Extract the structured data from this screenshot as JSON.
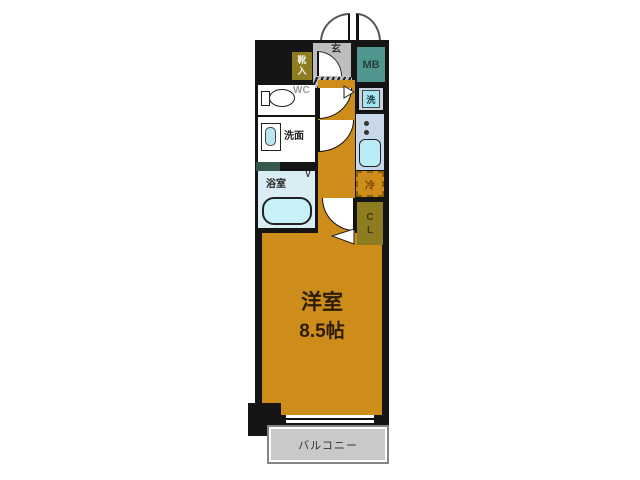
{
  "title": "floor-plan",
  "unit": {
    "main_room": {
      "name_line": "洋室",
      "size_line": "8.5帖"
    },
    "balcony": {
      "label": "バルコニー"
    },
    "entrance": {
      "label": "玄"
    },
    "shoe_cabinet": {
      "char_top": "靴",
      "char_bottom": "入"
    },
    "meter_box": {
      "label": "MB"
    },
    "toilet": {
      "label": "WC"
    },
    "washroom": {
      "label": "洗面"
    },
    "bathroom": {
      "label": "浴室",
      "door_mark": "∨"
    },
    "washer": {
      "label": "洗"
    },
    "refrigerator": {
      "label": "冷"
    },
    "closet": {
      "char_top": "C",
      "char_bottom": "L"
    }
  },
  "colors": {
    "wall_black": "#151515",
    "room_orange": "#CE8C1A",
    "balcony_gray": "#C9C9C9",
    "entrance_gray": "#BEBEBE",
    "storage_olive": "#8E7D20",
    "meter_box_teal": "#4F968E",
    "bathroom_blue": "#D8EEF4",
    "bathtub_blue": "#C8F2FA",
    "fixture_blue": "#B8ECF6",
    "counter_blue": "#C9D8E8",
    "washer_pan_gray": "#C8D2DE",
    "washer_blue": "#A8E4F0",
    "pipe_space_teal": "#37584E"
  }
}
